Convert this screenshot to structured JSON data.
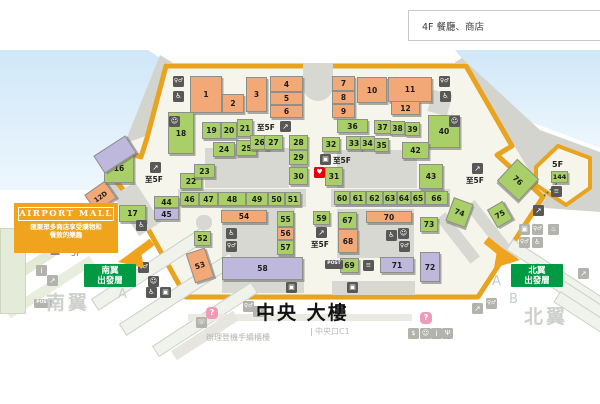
{
  "page": {
    "floor_label": "4F 餐廳、商店"
  },
  "banner": {
    "title": "AIRPORT MALL",
    "desc_line1": "匯聚眾多商店享受購物和",
    "desc_line2": "餐飲的樂趣"
  },
  "signs": {
    "south": {
      "line1": "南翼",
      "line2": "出發層",
      "x": 84,
      "y": 264,
      "w": 52,
      "h": 23
    },
    "north": {
      "line1": "北翼",
      "line2": "出發層",
      "x": 511,
      "y": 264,
      "w": 52,
      "h": 23
    }
  },
  "colors": {
    "food": "#f3a877",
    "shop": "#a8cf68",
    "service": "#bdb8dc",
    "boundary": "#e8a31f",
    "sign_green": "#009a44",
    "aed_red": "#e60012",
    "icon_dark": "#585856",
    "icon_light": "#b3b3ad",
    "sky": "#d3e9f8"
  },
  "labels": [
    {
      "t": "Z",
      "x": 50,
      "y": 244,
      "s": 14,
      "c": "#878c8d",
      "b": 1
    },
    {
      "t": "5F",
      "x": 71,
      "y": 250,
      "s": 8,
      "c": "#6d6d6d"
    },
    {
      "t": "A",
      "x": 118,
      "y": 288,
      "s": 13,
      "c": "#c6d1c6"
    },
    {
      "t": "A",
      "x": 492,
      "y": 275,
      "s": 13,
      "c": "#bfcdc7"
    },
    {
      "t": "B",
      "x": 509,
      "y": 293,
      "s": 13,
      "c": "#bfcdc7"
    },
    {
      "t": "南翼",
      "x": 46,
      "y": 294,
      "s": 19,
      "c": "#ccd1cc",
      "b": 1,
      "ls": 3
    },
    {
      "t": "北翼",
      "x": 524,
      "y": 308,
      "s": 19,
      "c": "#ccd1cc",
      "b": 1,
      "ls": 3
    },
    {
      "t": "中央 大樓",
      "x": 256,
      "y": 304,
      "s": 19,
      "c": "#111111",
      "b": 1,
      "ls": 2
    },
    {
      "t": "中央口C1",
      "x": 311,
      "y": 328,
      "s": 8,
      "c": "#b8bcb8",
      "line": 1
    },
    {
      "t": "辦理登機手續櫃檯",
      "x": 206,
      "y": 334,
      "s": 8,
      "c": "#b2b6b0"
    },
    {
      "t": "5F",
      "x": 552,
      "y": 161,
      "s": 8,
      "c": "#222222",
      "b": 1
    }
  ],
  "shops": [
    {
      "n": "1",
      "t": "food",
      "x": 190,
      "y": 76,
      "w": 32,
      "h": 37
    },
    {
      "n": "2",
      "t": "food",
      "x": 222,
      "y": 94,
      "w": 22,
      "h": 19
    },
    {
      "n": "3",
      "t": "food",
      "x": 246,
      "y": 77,
      "w": 21,
      "h": 35
    },
    {
      "n": "4",
      "t": "food",
      "x": 270,
      "y": 76,
      "w": 33,
      "h": 16
    },
    {
      "n": "5",
      "t": "food",
      "x": 270,
      "y": 92,
      "w": 33,
      "h": 13
    },
    {
      "n": "6",
      "t": "food",
      "x": 270,
      "y": 105,
      "w": 33,
      "h": 13
    },
    {
      "n": "7",
      "t": "food",
      "x": 332,
      "y": 76,
      "w": 23,
      "h": 15
    },
    {
      "n": "8",
      "t": "food",
      "x": 332,
      "y": 91,
      "w": 23,
      "h": 13
    },
    {
      "n": "9",
      "t": "food",
      "x": 332,
      "y": 104,
      "w": 23,
      "h": 14
    },
    {
      "n": "10",
      "t": "food",
      "x": 357,
      "y": 77,
      "w": 30,
      "h": 26
    },
    {
      "n": "11",
      "t": "food",
      "x": 388,
      "y": 77,
      "w": 44,
      "h": 25
    },
    {
      "n": "12",
      "t": "food",
      "x": 391,
      "y": 101,
      "w": 29,
      "h": 14
    },
    {
      "n": "12D",
      "t": "food",
      "x": 88,
      "y": 186,
      "w": 25,
      "h": 21,
      "r": -35
    },
    {
      "n": "16",
      "t": "shopc",
      "x": 104,
      "y": 153,
      "w": 30,
      "h": 30
    },
    {
      "n": "17",
      "t": "shopc",
      "x": 119,
      "y": 205,
      "w": 27,
      "h": 17
    },
    {
      "n": "18",
      "t": "shopc",
      "x": 168,
      "y": 112,
      "w": 26,
      "h": 42
    },
    {
      "n": "19",
      "t": "shopc",
      "x": 202,
      "y": 122,
      "w": 19,
      "h": 17
    },
    {
      "n": "20",
      "t": "shopc",
      "x": 221,
      "y": 122,
      "w": 16,
      "h": 17
    },
    {
      "n": "21",
      "t": "shopc",
      "x": 237,
      "y": 119,
      "w": 16,
      "h": 18
    },
    {
      "n": "22",
      "t": "shopc",
      "x": 180,
      "y": 173,
      "w": 22,
      "h": 16
    },
    {
      "n": "23",
      "t": "shopc",
      "x": 194,
      "y": 164,
      "w": 21,
      "h": 14
    },
    {
      "n": "24",
      "t": "shopc",
      "x": 213,
      "y": 142,
      "w": 22,
      "h": 15
    },
    {
      "n": "25",
      "t": "shopc",
      "x": 236,
      "y": 140,
      "w": 21,
      "h": 16
    },
    {
      "n": "26",
      "t": "shopc",
      "x": 250,
      "y": 135,
      "w": 19,
      "h": 15
    },
    {
      "n": "27",
      "t": "shopc",
      "x": 264,
      "y": 135,
      "w": 19,
      "h": 15
    },
    {
      "n": "28",
      "t": "shopc",
      "x": 289,
      "y": 135,
      "w": 19,
      "h": 15
    },
    {
      "n": "29",
      "t": "shopc",
      "x": 289,
      "y": 150,
      "w": 19,
      "h": 15
    },
    {
      "n": "30",
      "t": "shopc",
      "x": 289,
      "y": 167,
      "w": 19,
      "h": 18
    },
    {
      "n": "31",
      "t": "shopc",
      "x": 325,
      "y": 167,
      "w": 18,
      "h": 19
    },
    {
      "n": "32",
      "t": "shopc",
      "x": 322,
      "y": 137,
      "w": 18,
      "h": 15
    },
    {
      "n": "33",
      "t": "shopc",
      "x": 346,
      "y": 136,
      "w": 16,
      "h": 14
    },
    {
      "n": "34",
      "t": "shopc",
      "x": 360,
      "y": 136,
      "w": 15,
      "h": 14
    },
    {
      "n": "35",
      "t": "shopc",
      "x": 374,
      "y": 138,
      "w": 15,
      "h": 14
    },
    {
      "n": "36",
      "t": "shopc",
      "x": 337,
      "y": 119,
      "w": 31,
      "h": 14
    },
    {
      "n": "37",
      "t": "shopc",
      "x": 374,
      "y": 120,
      "w": 17,
      "h": 14
    },
    {
      "n": "38",
      "t": "shopc",
      "x": 390,
      "y": 121,
      "w": 15,
      "h": 14
    },
    {
      "n": "39",
      "t": "shopc",
      "x": 405,
      "y": 122,
      "w": 15,
      "h": 14
    },
    {
      "n": "40",
      "t": "shopc",
      "x": 428,
      "y": 115,
      "w": 32,
      "h": 33
    },
    {
      "n": "42",
      "t": "shopc",
      "x": 402,
      "y": 142,
      "w": 27,
      "h": 17
    },
    {
      "n": "43",
      "t": "shopc",
      "x": 419,
      "y": 164,
      "w": 24,
      "h": 25
    },
    {
      "n": "44",
      "t": "shopc",
      "x": 154,
      "y": 196,
      "w": 25,
      "h": 12
    },
    {
      "n": "45",
      "t": "svc",
      "x": 154,
      "y": 208,
      "w": 25,
      "h": 12
    },
    {
      "n": "46",
      "t": "shopc",
      "x": 180,
      "y": 192,
      "w": 19,
      "h": 14
    },
    {
      "n": "47",
      "t": "shopc",
      "x": 199,
      "y": 192,
      "w": 19,
      "h": 14
    },
    {
      "n": "48",
      "t": "shopc",
      "x": 218,
      "y": 192,
      "w": 28,
      "h": 14
    },
    {
      "n": "49",
      "t": "shopc",
      "x": 246,
      "y": 192,
      "w": 22,
      "h": 14
    },
    {
      "n": "50",
      "t": "shopc",
      "x": 268,
      "y": 192,
      "w": 17,
      "h": 14
    },
    {
      "n": "51",
      "t": "shopc",
      "x": 285,
      "y": 192,
      "w": 16,
      "h": 14
    },
    {
      "n": "52",
      "t": "shopc",
      "x": 194,
      "y": 231,
      "w": 17,
      "h": 15
    },
    {
      "n": "53",
      "t": "food",
      "x": 190,
      "y": 250,
      "w": 20,
      "h": 31,
      "r": -18
    },
    {
      "n": "54",
      "t": "food",
      "x": 221,
      "y": 210,
      "w": 46,
      "h": 13
    },
    {
      "n": "55",
      "t": "shopc",
      "x": 277,
      "y": 211,
      "w": 17,
      "h": 16
    },
    {
      "n": "56",
      "t": "food",
      "x": 277,
      "y": 227,
      "w": 17,
      "h": 13
    },
    {
      "n": "57",
      "t": "shopc",
      "x": 277,
      "y": 240,
      "w": 17,
      "h": 15
    },
    {
      "n": "58",
      "t": "svc",
      "x": 222,
      "y": 257,
      "w": 81,
      "h": 23
    },
    {
      "n": "59",
      "t": "shopc",
      "x": 313,
      "y": 211,
      "w": 17,
      "h": 14
    },
    {
      "n": "60",
      "t": "shopc",
      "x": 334,
      "y": 191,
      "w": 16,
      "h": 14
    },
    {
      "n": "61",
      "t": "shopc",
      "x": 350,
      "y": 191,
      "w": 16,
      "h": 14
    },
    {
      "n": "62",
      "t": "shopc",
      "x": 366,
      "y": 191,
      "w": 17,
      "h": 14
    },
    {
      "n": "63",
      "t": "shopc",
      "x": 383,
      "y": 191,
      "w": 14,
      "h": 14
    },
    {
      "n": "64",
      "t": "shopc",
      "x": 397,
      "y": 191,
      "w": 14,
      "h": 14
    },
    {
      "n": "65",
      "t": "shopc",
      "x": 411,
      "y": 191,
      "w": 14,
      "h": 14
    },
    {
      "n": "66",
      "t": "shopc",
      "x": 425,
      "y": 191,
      "w": 23,
      "h": 14
    },
    {
      "n": "67",
      "t": "shopc",
      "x": 338,
      "y": 212,
      "w": 19,
      "h": 17
    },
    {
      "n": "68",
      "t": "food",
      "x": 338,
      "y": 229,
      "w": 20,
      "h": 24
    },
    {
      "n": "69",
      "t": "shopc",
      "x": 340,
      "y": 258,
      "w": 19,
      "h": 15
    },
    {
      "n": "70",
      "t": "food",
      "x": 366,
      "y": 211,
      "w": 46,
      "h": 12
    },
    {
      "n": "71",
      "t": "svc",
      "x": 380,
      "y": 257,
      "w": 34,
      "h": 16
    },
    {
      "n": "72",
      "t": "svc",
      "x": 420,
      "y": 252,
      "w": 20,
      "h": 30
    },
    {
      "n": "73",
      "t": "shopc",
      "x": 420,
      "y": 217,
      "w": 18,
      "h": 15
    },
    {
      "n": "74",
      "t": "shopc",
      "x": 449,
      "y": 200,
      "w": 21,
      "h": 25,
      "r": 20
    },
    {
      "n": "75",
      "t": "shopc",
      "x": 491,
      "y": 204,
      "w": 18,
      "h": 21,
      "r": -30
    },
    {
      "n": "76",
      "t": "shopc",
      "x": 503,
      "y": 165,
      "w": 30,
      "h": 30,
      "r": 43
    },
    {
      "n": "144",
      "t": "shopc",
      "x": 551,
      "y": 171,
      "w": 17,
      "h": 12
    },
    {
      "n": "",
      "t": "svc",
      "x": 96,
      "y": 144,
      "w": 38,
      "h": 21,
      "r": -33
    }
  ],
  "icon_glyphs": {
    "toilet": "♀♂",
    "access": "♿",
    "escalator": "↗",
    "stairs": "≡",
    "elevator": "▣",
    "post": "POST",
    "aed": "♥",
    "info": "i",
    "question": "?",
    "baby": "☺",
    "smoking": "♨",
    "exchange": "$",
    "restaurant": "Ψ",
    "phone": "☏"
  },
  "to5f_label": "至5F",
  "icons": [
    {
      "k": "toilet",
      "x": 173,
      "y": 76,
      "tn": "dark"
    },
    {
      "k": "access",
      "x": 173,
      "y": 91,
      "tn": "dark"
    },
    {
      "k": "baby",
      "x": 169,
      "y": 116,
      "tn": "dark"
    },
    {
      "k": "toilet",
      "x": 439,
      "y": 76,
      "tn": "dark"
    },
    {
      "k": "access",
      "x": 440,
      "y": 91,
      "tn": "dark"
    },
    {
      "k": "baby",
      "x": 449,
      "y": 116,
      "tn": "dark"
    },
    {
      "k": "escalator",
      "x": 280,
      "y": 121,
      "tn": "dark",
      "lb": 1,
      "lx": 257,
      "ly": 124
    },
    {
      "k": "elevator",
      "x": 320,
      "y": 154,
      "tn": "dark",
      "lb": 1,
      "lx": 333,
      "ly": 157
    },
    {
      "k": "aed",
      "x": 314,
      "y": 167,
      "tn": "red"
    },
    {
      "k": "escalator",
      "x": 150,
      "y": 162,
      "tn": "dark",
      "lb": 1,
      "lx": 145,
      "ly": 176
    },
    {
      "k": "access",
      "x": 136,
      "y": 220,
      "tn": "dark"
    },
    {
      "k": "escalator",
      "x": 472,
      "y": 163,
      "tn": "dark",
      "lb": 1,
      "lx": 466,
      "ly": 177
    },
    {
      "k": "escalator",
      "x": 316,
      "y": 227,
      "tn": "dark",
      "lb": 1,
      "lx": 311,
      "ly": 241
    },
    {
      "k": "stairs",
      "x": 551,
      "y": 186,
      "tn": "dark"
    },
    {
      "k": "escalator",
      "x": 533,
      "y": 205,
      "tn": "dark"
    },
    {
      "k": "elevator",
      "x": 519,
      "y": 224,
      "tn": "light"
    },
    {
      "k": "toilet",
      "x": 532,
      "y": 224,
      "tn": "light"
    },
    {
      "k": "smoking",
      "x": 548,
      "y": 224,
      "tn": "light"
    },
    {
      "k": "toilet",
      "x": 519,
      "y": 237,
      "tn": "light"
    },
    {
      "k": "access",
      "x": 532,
      "y": 237,
      "tn": "light"
    },
    {
      "k": "access",
      "x": 226,
      "y": 228,
      "tn": "dark"
    },
    {
      "k": "toilet",
      "x": 226,
      "y": 241,
      "tn": "dark"
    },
    {
      "k": "access",
      "x": 386,
      "y": 230,
      "tn": "dark"
    },
    {
      "k": "baby",
      "x": 398,
      "y": 228,
      "tn": "dark"
    },
    {
      "k": "toilet",
      "x": 399,
      "y": 241,
      "tn": "dark"
    },
    {
      "k": "stairs",
      "x": 363,
      "y": 260,
      "tn": "dark"
    },
    {
      "k": "post",
      "x": 325,
      "y": 260,
      "tn": "dark"
    },
    {
      "k": "elevator",
      "x": 347,
      "y": 282,
      "tn": "dark"
    },
    {
      "k": "elevator",
      "x": 286,
      "y": 282,
      "tn": "dark"
    },
    {
      "k": "toilet",
      "x": 138,
      "y": 262,
      "tn": "dark"
    },
    {
      "k": "baby",
      "x": 148,
      "y": 276,
      "tn": "dark"
    },
    {
      "k": "access",
      "x": 146,
      "y": 287,
      "tn": "dark"
    },
    {
      "k": "elevator",
      "x": 160,
      "y": 287,
      "tn": "dark"
    },
    {
      "k": "info",
      "x": 36,
      "y": 265,
      "tn": "light"
    },
    {
      "k": "escalator",
      "x": 47,
      "y": 275,
      "tn": "light"
    },
    {
      "k": "post",
      "x": 34,
      "y": 299,
      "tn": "light"
    },
    {
      "k": "escalator",
      "x": 578,
      "y": 268,
      "tn": "light"
    },
    {
      "k": "question",
      "x": 206,
      "y": 307,
      "tn": "q"
    },
    {
      "k": "phone",
      "x": 196,
      "y": 317,
      "tn": "light"
    },
    {
      "k": "toilet",
      "x": 243,
      "y": 301,
      "tn": "light"
    },
    {
      "k": "escalator",
      "x": 253,
      "y": 306,
      "tn": "light"
    },
    {
      "k": "escalator",
      "x": 472,
      "y": 303,
      "tn": "light"
    },
    {
      "k": "toilet",
      "x": 486,
      "y": 298,
      "tn": "light"
    },
    {
      "k": "question",
      "x": 420,
      "y": 312,
      "tn": "q"
    },
    {
      "k": "exchange",
      "x": 408,
      "y": 328,
      "tn": "light"
    },
    {
      "k": "baby",
      "x": 420,
      "y": 328,
      "tn": "light"
    },
    {
      "k": "info",
      "x": 431,
      "y": 328,
      "tn": "light"
    },
    {
      "k": "restaurant",
      "x": 442,
      "y": 328,
      "tn": "light"
    }
  ],
  "shapes": [
    {
      "x": 205,
      "y": 148,
      "w": 84,
      "h": 40,
      "f": "#d8d8d2"
    },
    {
      "x": 337,
      "y": 150,
      "w": 80,
      "h": 38,
      "f": "#d8d8d2"
    },
    {
      "x": 178,
      "y": 189,
      "w": 128,
      "h": 18,
      "f": "#d8d8d2"
    },
    {
      "x": 331,
      "y": 189,
      "w": 119,
      "h": 18,
      "f": "#d8d8d2"
    },
    {
      "x": 222,
      "y": 208,
      "w": 73,
      "h": 49,
      "f": "#d8d8d2"
    },
    {
      "x": 337,
      "y": 209,
      "w": 77,
      "h": 49,
      "f": "#d8d8d2"
    },
    {
      "x": 222,
      "y": 279,
      "w": 82,
      "h": 14,
      "f": "#d8d8d2"
    },
    {
      "x": 332,
      "y": 281,
      "w": 83,
      "h": 14,
      "f": "#d8d8d2"
    },
    {
      "x": 124,
      "y": 185,
      "w": 26,
      "h": 48,
      "r": -33,
      "f": "#d8d8d2"
    },
    {
      "x": 196,
      "y": 215,
      "w": 16,
      "h": 15,
      "f": "#d8d8d2",
      "rad": "7px"
    },
    {
      "x": 303,
      "y": 63,
      "w": 30,
      "h": 38,
      "f": "#d8d8d2",
      "rad": "0 0 16px 16px"
    },
    {
      "x": 430,
      "y": 92,
      "w": 20,
      "h": 22,
      "r": 15,
      "f": "#d8d8d2"
    },
    {
      "x": 430,
      "y": 232,
      "w": 56,
      "h": 12,
      "r": 52,
      "f": "#d8d8d2"
    },
    {
      "x": 456,
      "y": 226,
      "w": 72,
      "h": 12,
      "r": 52,
      "f": "#d8d8d2"
    },
    {
      "x": 84,
      "y": 262,
      "w": 132,
      "h": 14,
      "r": -33,
      "f": "#f0f2ec",
      "s": "#ccd2c8"
    },
    {
      "x": 112,
      "y": 287,
      "w": 132,
      "h": 14,
      "r": -33,
      "f": "#f0f2ec",
      "s": "#ccd2c8"
    },
    {
      "x": 146,
      "y": 313,
      "w": 118,
      "h": 13,
      "r": -33,
      "f": "#f0f2ec",
      "s": "#ccd2c8"
    },
    {
      "x": 2,
      "y": 250,
      "w": 92,
      "h": 10,
      "r": -33,
      "f": "#e2ead6"
    },
    {
      "x": 0,
      "y": 282,
      "w": 100,
      "h": 10,
      "r": -33,
      "f": "#e7eedd"
    },
    {
      "x": 0,
      "y": 228,
      "w": 26,
      "h": 86,
      "f": "#e4ebd8",
      "s": "#cdd6bf"
    },
    {
      "x": 500,
      "y": 270,
      "w": 118,
      "h": 13,
      "r": 33,
      "f": "#f0f2ec",
      "s": "#ccd2c8"
    },
    {
      "x": 524,
      "y": 294,
      "w": 118,
      "h": 13,
      "r": 33,
      "f": "#f0f2ec",
      "s": "#ccd2c8"
    },
    {
      "x": 548,
      "y": 320,
      "w": 110,
      "h": 13,
      "r": 33,
      "f": "#f0f2ec",
      "s": "#ccd2c8"
    },
    {
      "x": 188,
      "y": 314,
      "w": 224,
      "h": 7,
      "f": "#eaeae3"
    },
    {
      "x": 168,
      "y": 330,
      "w": 74,
      "h": 11,
      "r": -33,
      "f": "#e6e6df"
    }
  ]
}
